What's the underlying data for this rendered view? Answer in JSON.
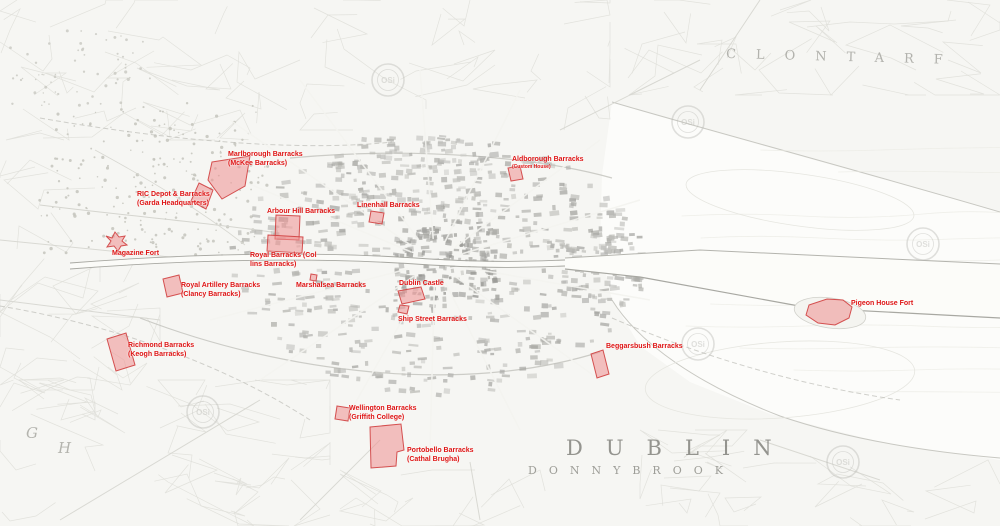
{
  "colors": {
    "paper": "#f6f6f3",
    "water": "#fcfcfa",
    "overlay_fill": "#ef8f8f",
    "overlay_stroke": "#d04040",
    "site_label_text": "#de1414",
    "place_label_text": "#9a9a94",
    "watermark": "#bdbdb8",
    "map_ink": "#b0b0aa"
  },
  "places": {
    "clontarf": "CLONTARF",
    "dublin": "DUBLIN",
    "donnybrook": "DONNYBROOK",
    "letter_g": "G",
    "letter_h": "H"
  },
  "watermark_text": "OSi",
  "watermarks": [
    {
      "x": 203,
      "y": 412
    },
    {
      "x": 388,
      "y": 80
    },
    {
      "x": 688,
      "y": 122
    },
    {
      "x": 698,
      "y": 344
    },
    {
      "x": 843,
      "y": 462
    },
    {
      "x": 923,
      "y": 244
    }
  ],
  "sites": [
    {
      "id": "marlborough-barracks",
      "label1": "Marlborough Barracks",
      "label2": "(McKee Barracks)",
      "lx": 228,
      "ly": 150,
      "shape": "212,162 250,156 245,186 222,199 208,180"
    },
    {
      "id": "ric-depot-barracks",
      "label1": "RIC Depot & Barracks",
      "label2": "(Garda Headquarters)",
      "lx": 137,
      "ly": 190,
      "shape": "199,183 213,190 206,209 191,201"
    },
    {
      "id": "magazine-fort",
      "label1": "Magazine Fort",
      "label2": null,
      "lx": 112,
      "ly": 249,
      "shape": "115,232 119,237 125,236 122,241 127,245 121,246 118,251 114,246 107,247 111,241 106,236 112,238"
    },
    {
      "id": "arbour-hill-barracks",
      "label1": "Arbour Hill Barracks",
      "label2": null,
      "lx": 267,
      "ly": 207,
      "shape": "276,215 300,216 299,240 275,239"
    },
    {
      "id": "royal-barracks",
      "label1": "Royal Barracks (Col",
      "label2": "lins Barracks)",
      "lx": 250,
      "ly": 251,
      "shape": "268,235 303,237 302,253 267,251"
    },
    {
      "id": "linenhall-barracks",
      "label1": "Linenhall Barracks",
      "label2": null,
      "lx": 357,
      "ly": 201,
      "shape": "371,211 384,213 382,224 369,222"
    },
    {
      "id": "aldborough-barracks",
      "label1": "Aldborough Barracks",
      "label2": "(Custom House)",
      "label2_small": true,
      "lx": 512,
      "ly": 155,
      "shape": "508,168 520,166 523,179 511,181"
    },
    {
      "id": "marshalsea-barracks",
      "label1": "Marshalsea Barracks",
      "label2": null,
      "lx": 296,
      "ly": 281,
      "shape": "311,274 317,275 316,281 310,280"
    },
    {
      "id": "dublin-castle",
      "label1": "Dublin Castle",
      "label2": null,
      "lx": 399,
      "ly": 279,
      "shape": "398,291 421,287 425,299 402,304"
    },
    {
      "id": "ship-street-barracks",
      "label1": "Ship Street Barracks",
      "label2": null,
      "lx": 398,
      "ly": 315,
      "shape": "400,305 409,306 407,314 398,312"
    },
    {
      "id": "royal-artillery-barracks",
      "label1": "Royal Artillery Barracks",
      "label2": "(Clancy Barracks)",
      "lx": 181,
      "ly": 281,
      "shape": "163,279 179,275 183,293 167,297"
    },
    {
      "id": "richmond-barracks",
      "label1": "Richmond Barracks",
      "label2": "(Keogh Barracks)",
      "lx": 128,
      "ly": 341,
      "shape": "107,339 126,333 135,365 116,371"
    },
    {
      "id": "wellington-barracks",
      "label1": "Wellington Barracks",
      "label2": "(Griffith College)",
      "lx": 349,
      "ly": 404,
      "shape": "337,406 350,408 348,421 335,419"
    },
    {
      "id": "portobello-barracks",
      "label1": "Portobello Barracks",
      "label2": "(Cathal Brugha)",
      "lx": 407,
      "ly": 446,
      "shape": "370,427 401,424 404,450 397,452 396,466 371,468"
    },
    {
      "id": "beggarsbush-barracks",
      "label1": "Beggarsbush Barracks",
      "label2": null,
      "lx": 606,
      "ly": 342,
      "shape": "591,354 603,350 609,374 597,378"
    },
    {
      "id": "pigeon-house-fort",
      "label1": "Pigeon House Fort",
      "label2": null,
      "lx": 851,
      "ly": 299,
      "shape": "809,305 827,299 843,300 852,307 849,318 835,325 818,323 806,315"
    }
  ]
}
